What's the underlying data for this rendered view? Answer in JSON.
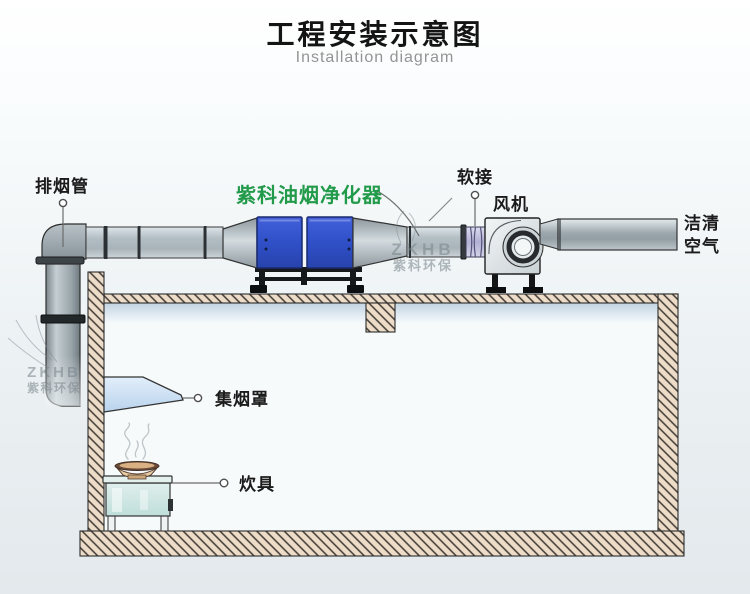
{
  "header": {
    "title_zh": "工程安装示意图",
    "title_en": "Installation diagram"
  },
  "labels": {
    "exhaust_pipe": "排烟管",
    "purifier": "紫科油烟净化器",
    "soft_joint": "软接",
    "fan": "风机",
    "clean_air": "洁清\n空气",
    "hood": "集烟罩",
    "cooker": "炊具"
  },
  "watermark": {
    "l1": "ZKHB",
    "l2": "紫科环保"
  },
  "colors": {
    "label_green": "#219a4a",
    "purifier_blue": "#3050c8",
    "hatch_fill": "#eddcc8",
    "duct_gray": "#b6c1c7"
  }
}
